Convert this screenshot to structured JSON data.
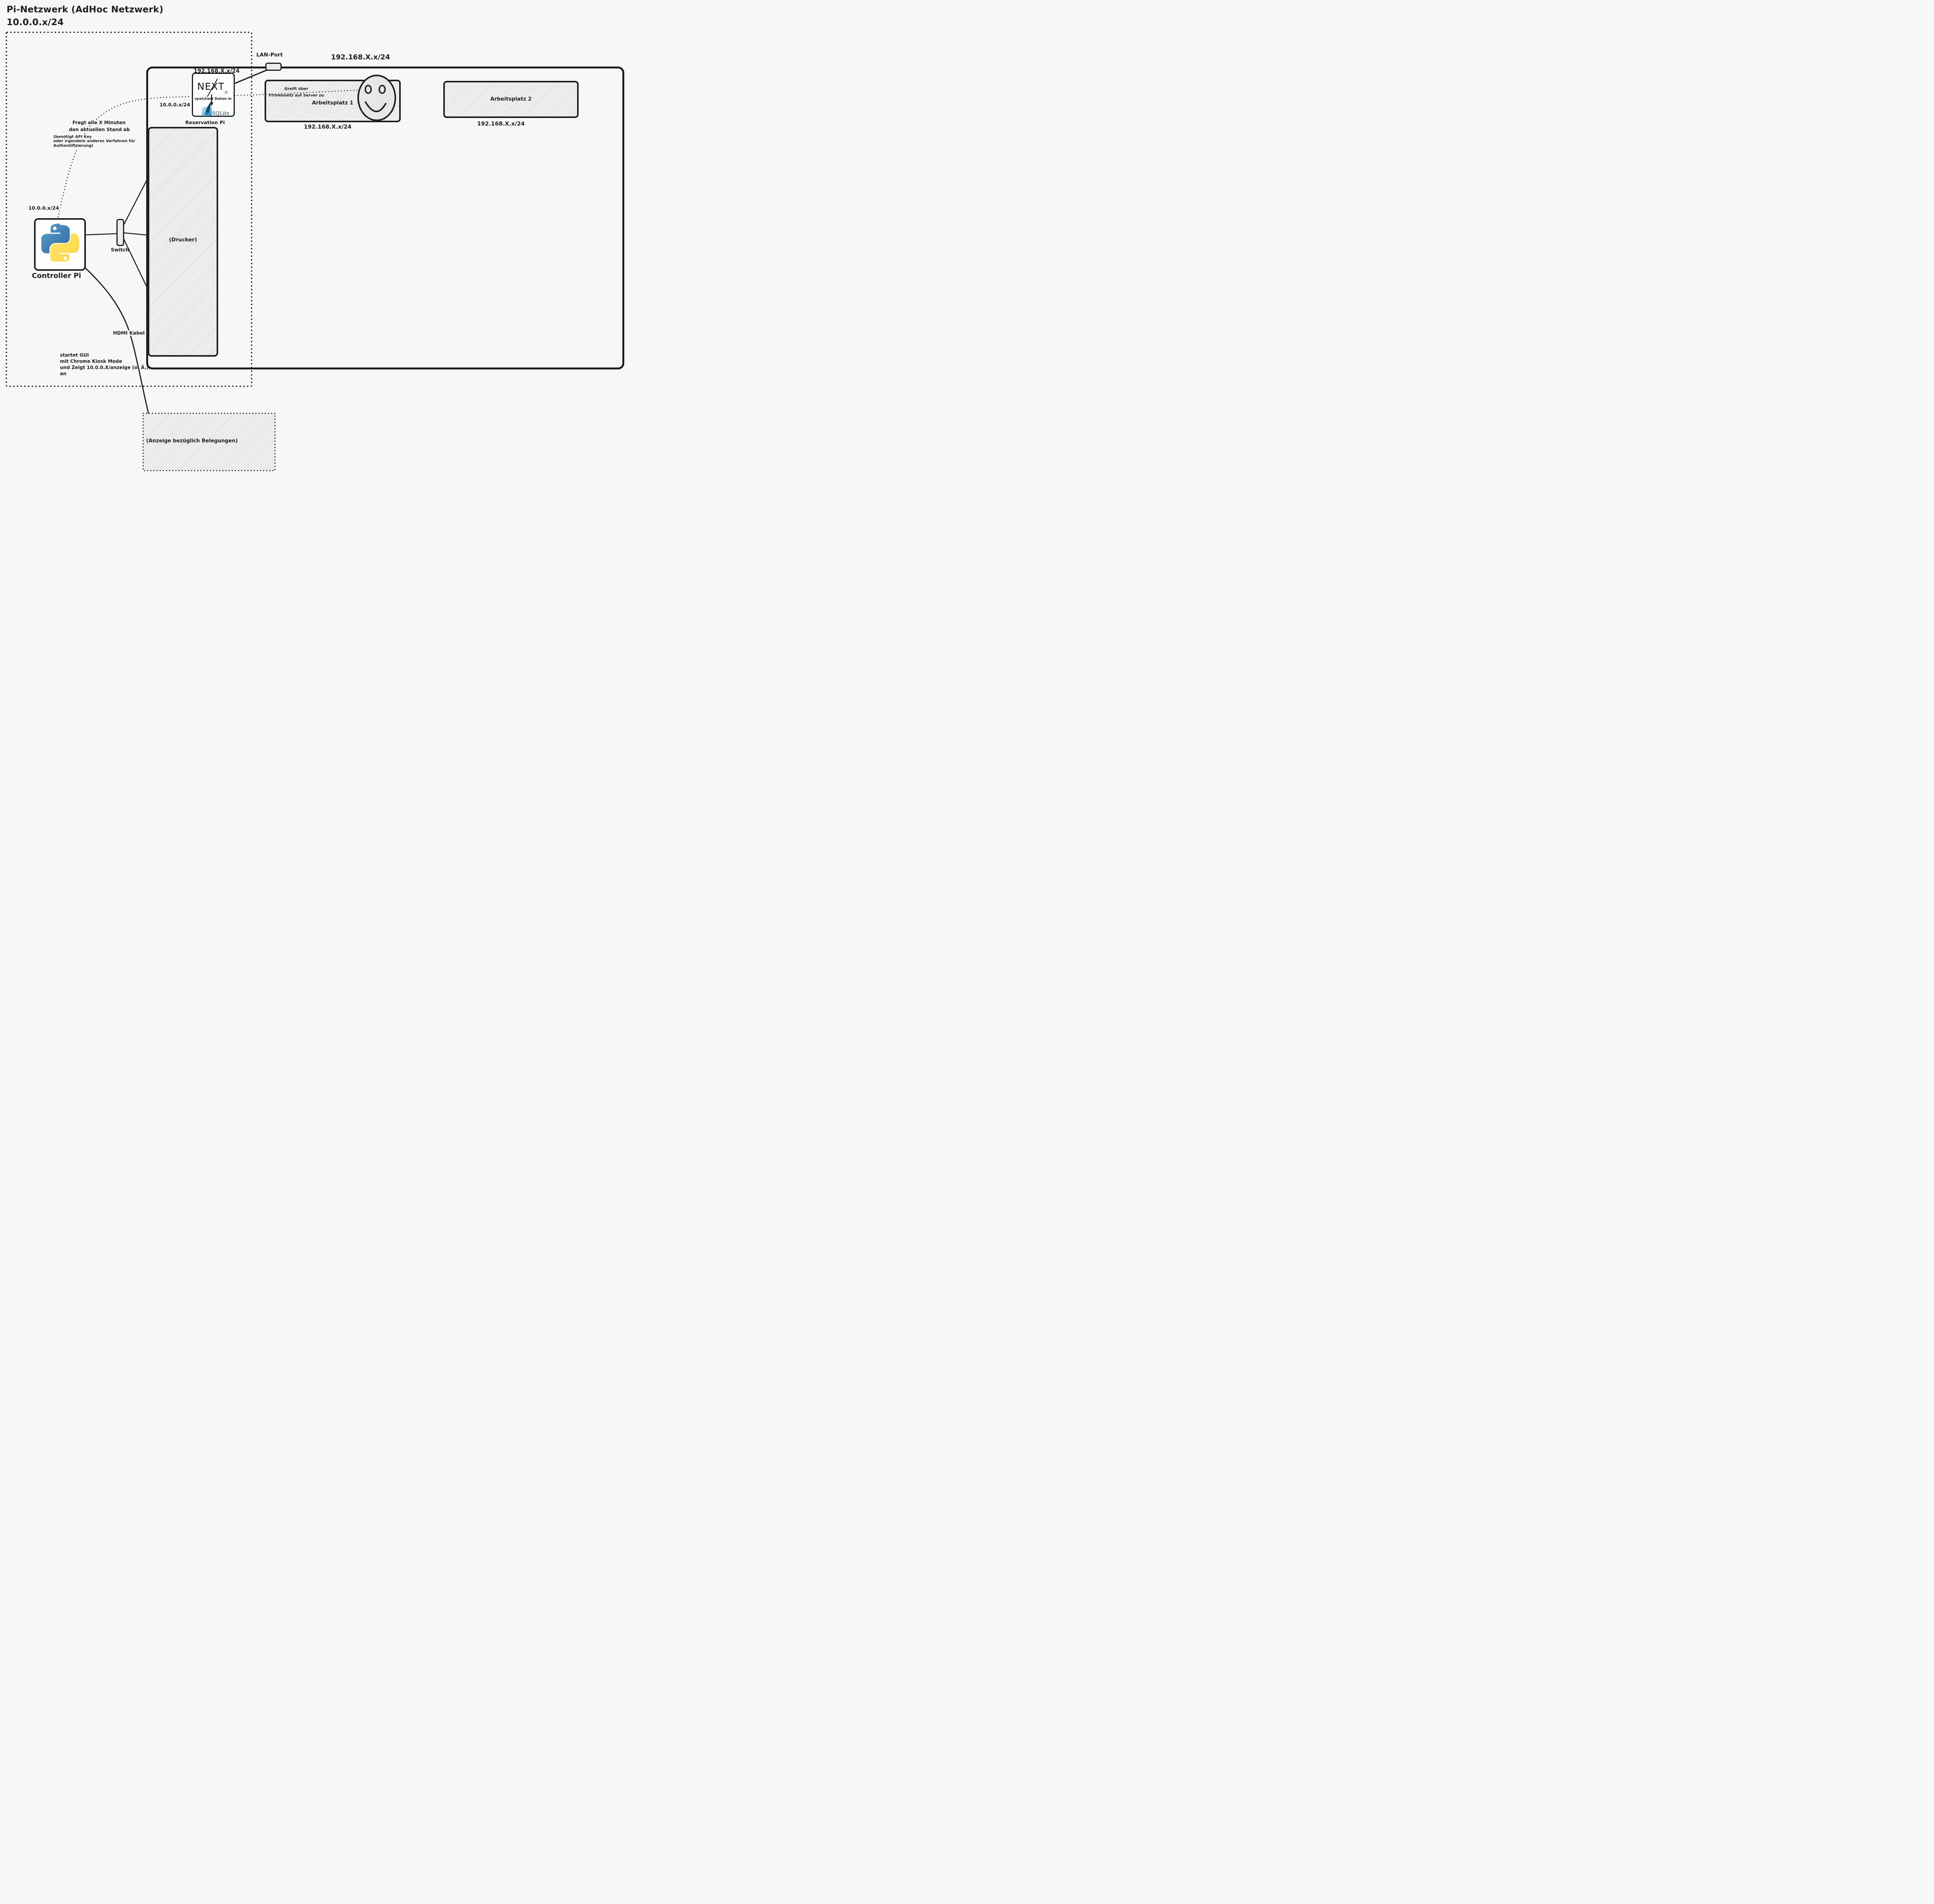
{
  "colors": {
    "background": "#f6f7f8",
    "stroke": "#1e1e1e",
    "hatch_fill": "#fcfcfb",
    "smiley_fill": "#e7e7e7",
    "python_blue_top": "#5a9fd4",
    "python_blue_bottom": "#306998",
    "python_yellow_top": "#ffe873",
    "python_yellow_bottom": "#ffd43b",
    "sqlite_navy": "#0d4a66",
    "sqlite_square_light": "#d4ecf9",
    "sqlite_square_dark": "#1186c9"
  },
  "icons": {
    "python-logo": "two interlocked python snakes (blue/yellow)",
    "nextjs-logo": "NEXT wordmark with diagonal stroke and .JS suffix",
    "sqlite-logo": "blue rounded square with quill feather and SQLite serif wordmark",
    "smiley-face-icon": "hand-drawn oval smiley with oval eyes",
    "lan-port-icon": "small hatched rounded connector on network boundary"
  },
  "title": {
    "line1": "Pi-Netzwerk (AdHoc Netzwerk)",
    "line2": "10.0.0.x/24"
  },
  "pi_network": {
    "controller": {
      "name": "Controller Pi",
      "subnet": "10.0.0.x/24"
    },
    "switch_label": "Switch",
    "printer_label": "(Drucker)",
    "hdmi_label": "HDMI Kabel",
    "display_label": "(Anzeige bezüglich Belegungen)",
    "gui_note": [
      "startet GUI",
      "mit Chrome Kiosk Mode",
      "und Zeigt 10.0.0.X/anzeige (o. Ä.)",
      "an"
    ],
    "poll_note": [
      "Fragt alle X Minuten",
      "den aktuellen Stand ab"
    ],
    "auth_note": [
      "(benötigt API Key",
      "oder irgendein anderes Verfahren für",
      "Authentifizierung)"
    ]
  },
  "reservation_pi": {
    "name": "Reservation Pi",
    "subnet_company": "192.168.X.x/24",
    "subnet_pi": "10.0.0.x/24",
    "nextjs_text": "NEXT",
    "nextjs_js": ".JS",
    "stores_note": "speichert Daten in",
    "sqlite_text": "SQLite"
  },
  "company_network": {
    "lan_port": "LAN-Port",
    "subnet": "192.168.X.x/24",
    "workstation1": {
      "name": "Arbeitsplatz 1",
      "subnet": "192.168.X.x/24",
      "note": [
        "Greift über",
        "Firmennetz auf Server zu"
      ]
    },
    "workstation2": {
      "name": "Arbeitsplatz 2",
      "subnet": "192.168.X.x/24"
    }
  }
}
